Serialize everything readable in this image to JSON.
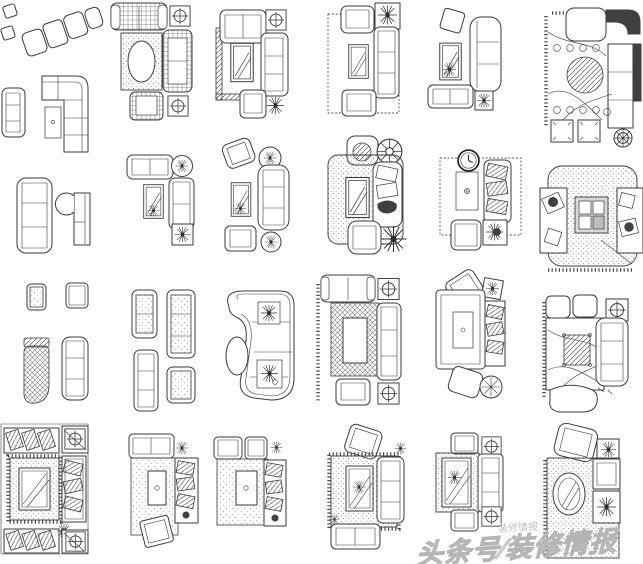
{
  "page": {
    "background_color": "#ffffff",
    "line_color": "#3a3a3a",
    "description_label": "CAD plan-view sofa and living-room furniture blocks"
  },
  "watermark": {
    "small": "装修情报",
    "main": "头条号∕装修情报",
    "color": "#c7c7c7"
  },
  "blocks": [
    {
      "label": "angled-chair-row"
    },
    {
      "label": "l-shaped-sofa-with-side-sofa-and-table"
    },
    {
      "label": "plaid-sofa-set-with-oval-rug-and-crosshair-tables"
    },
    {
      "label": "sofa-set-with-mirror-coffee-table-and-plant"
    },
    {
      "label": "sofa-set-with-dashed-rug-and-dark-plant-table"
    },
    {
      "label": "chaise-sofa-group-with-mirror-table"
    },
    {
      "label": "luxury-corner-sofa-with-round-hatched-table"
    },
    {
      "label": "straight-sofa-and-rounded-chaise"
    },
    {
      "label": "compact-sofa-set-with-plant-tables"
    },
    {
      "label": "sofa-set-with-round-side-tables"
    },
    {
      "label": "sofa-set-with-stippled-rug-and-fan-table"
    },
    {
      "label": "sofa-set-with-clock-and-dashed-rug"
    },
    {
      "label": "square-stippled-rug-lounge-set"
    },
    {
      "label": "single-armchairs-and-crosshatch-chaise"
    },
    {
      "label": "tufted-fabric-sofa-group"
    },
    {
      "label": "curved-p-shaped-sofa-with-oval-rug"
    },
    {
      "label": "sofa-set-with-floral-rug-and-crosshair-tables"
    },
    {
      "label": "sofa-set-with-round-end-table"
    },
    {
      "label": "corner-lounge-with-hatched-center-table"
    },
    {
      "label": "ornate-square-rug-living-set"
    },
    {
      "label": "sofa-set-with-tilted-end-table"
    },
    {
      "label": "twin-armchair-sofa-set"
    },
    {
      "label": "sofa-set-with-dotted-rug-and-mirror-table"
    },
    {
      "label": "symmetric-sofa-set-with-crosshair-tables"
    },
    {
      "label": "luxury-lounge-with-oval-mirror-rug"
    }
  ]
}
